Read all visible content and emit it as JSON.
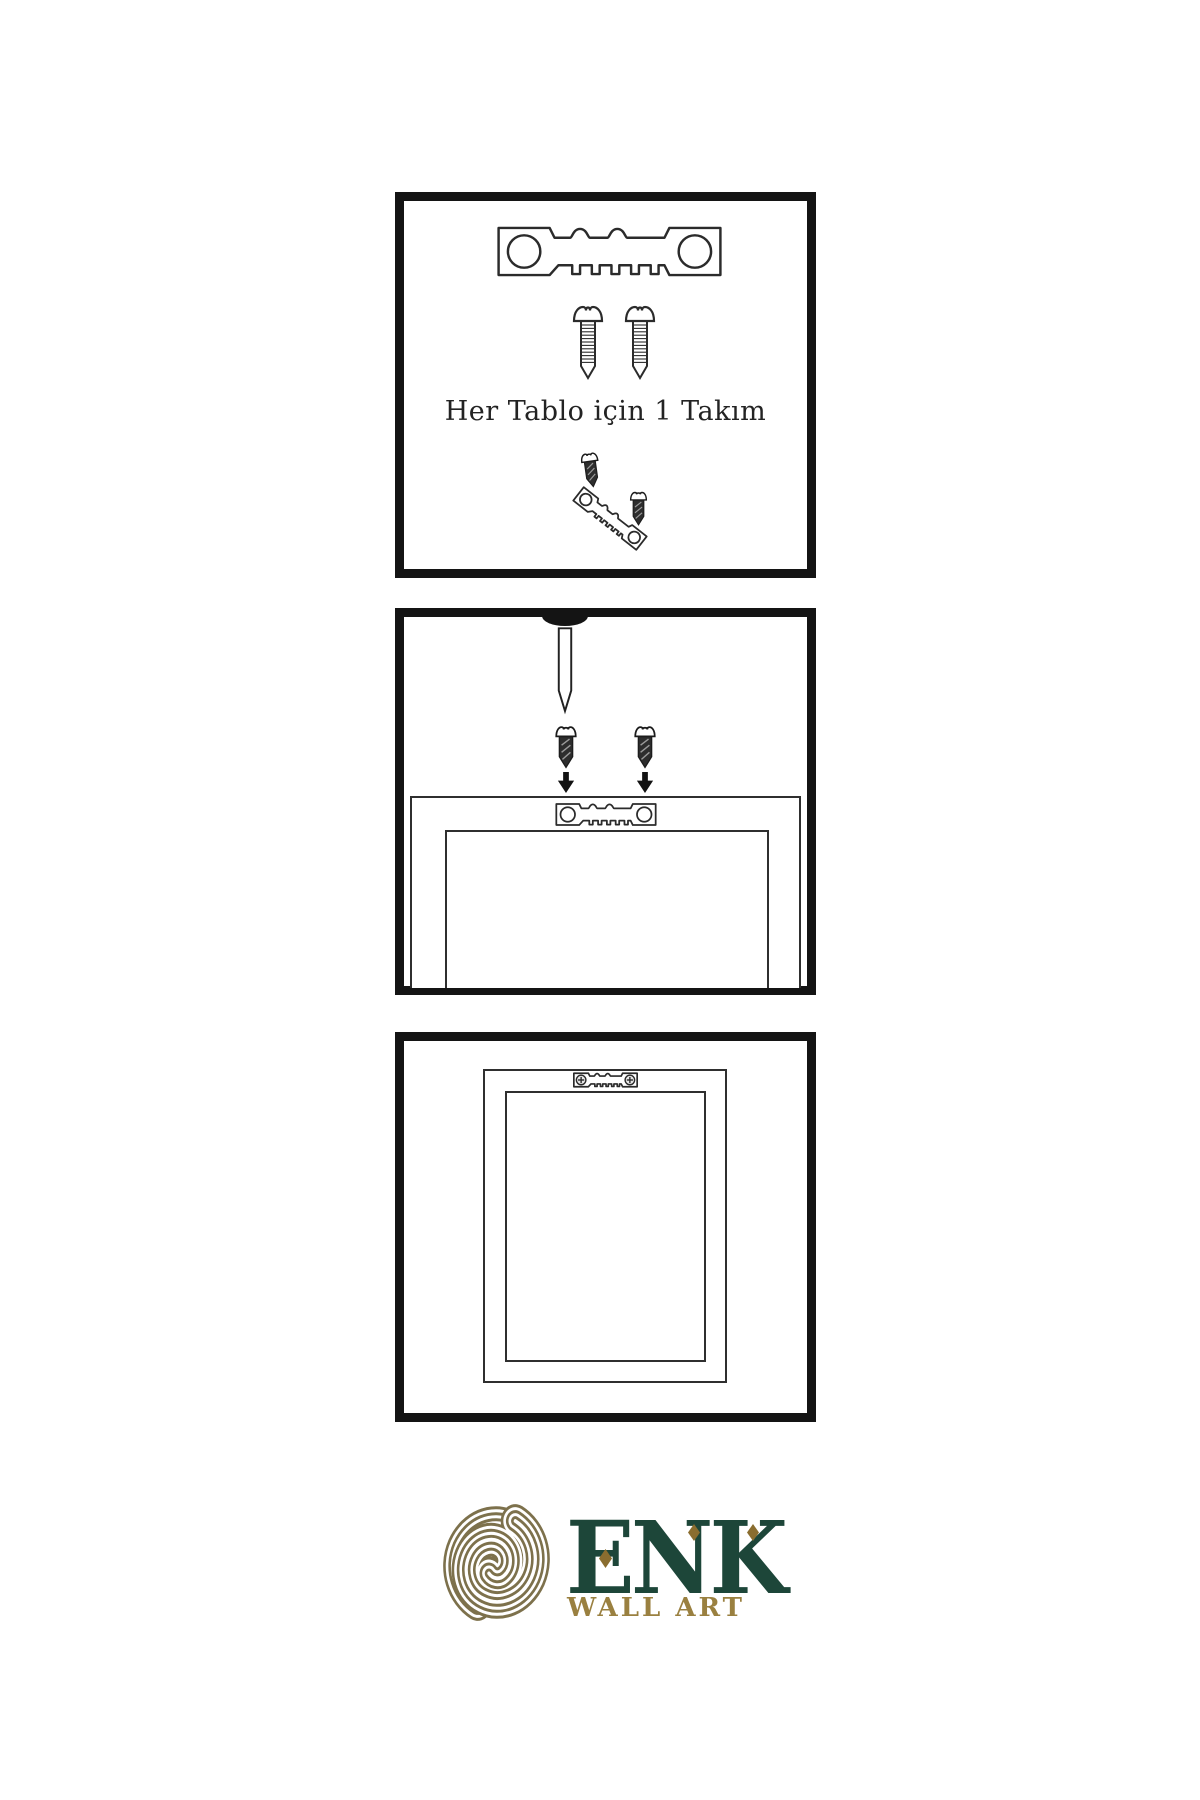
{
  "instructions": {
    "step1": {
      "caption": "Her Tablo için 1 Takım"
    }
  },
  "logo": {
    "brand": "ENK",
    "subtitle": "WALL ART"
  },
  "icons": {
    "sawtooth_hanger": "sawtooth-hanger-icon",
    "screw": "screw-icon",
    "nail": "nail-icon",
    "arrow_down": "arrow-down-icon",
    "knot": "knot-logo-icon"
  },
  "colors": {
    "ink": "#2b2b2b",
    "panel_border": "#141414",
    "logo_knot_gold": "#7d714c",
    "logo_subtitle_gold": "#9a8040",
    "brand_green": "#1d4639",
    "accent_diamond": "#8a6d2f"
  }
}
